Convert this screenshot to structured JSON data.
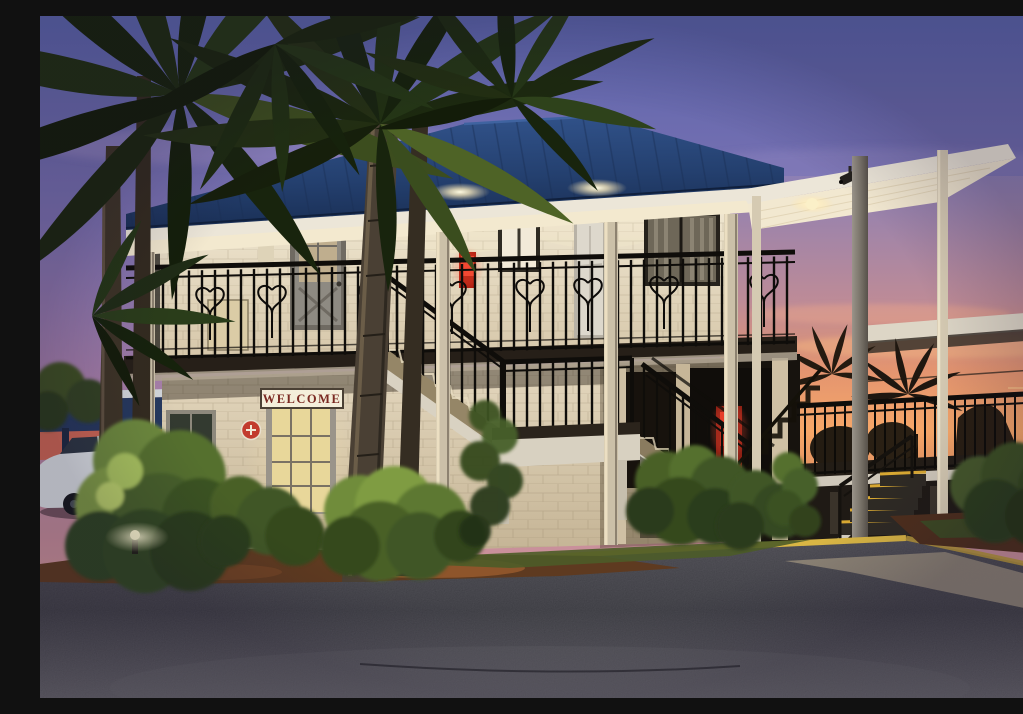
{
  "scene": {
    "title": "Two-story motel exterior at dusk",
    "description": "White brick two-story motel with dark blue standing-seam metal roof, black wrought-iron balcony railings, exterior staircase with mid landing, an open flat-roofed sun deck on the right, palm trees and shrubs in front, asphalt drive with yellow-painted curb, purple-to-orange sunset sky.",
    "time_of_day": "dusk",
    "weather": "clear with pink and purple clouds"
  },
  "signs": {
    "welcome_sign": "WELCOME"
  },
  "objects": {
    "building": "two-story motel with second-floor balcony",
    "roof": "dark blue standing-seam metal hip roof",
    "right_structure": "flat-roofed open sun deck with black railing and yellow-edged steps",
    "staircase": "central exterior staircase with landing",
    "vehicle": "white SUV parked at far left",
    "vegetation": "sabal palm trees and green shrubs",
    "lighting": "warm soffit lights, lit welcome door, landscape uplight",
    "extras": "red fire-extinguisher box on balcony wall, red life-ring emblem beside welcome door, security camera under right canopy, red vending machine glow in breezeway, setting sun visible through deck railing"
  },
  "palette": {
    "sky_top": "#5a64ab",
    "sky_mid": "#a87fa8",
    "sky_horizon": "#e2a38e",
    "sunset_orange": "#f7a768",
    "roof_blue": "#33558e",
    "wall_warm_white": "#efe6d0",
    "trim_white": "#ece6d8",
    "railing_black": "#0f0d0a",
    "foliage_lit": "#7f9c42",
    "foliage_dark": "#223014",
    "mulch_brown": "#7c4a28",
    "curb_yellow": "#c7a23b",
    "asphalt_gray": "#4a4950",
    "door_glow": "#e8d79a",
    "firebox_red": "#ef4430",
    "sign_text_red": "#7a2a22"
  }
}
